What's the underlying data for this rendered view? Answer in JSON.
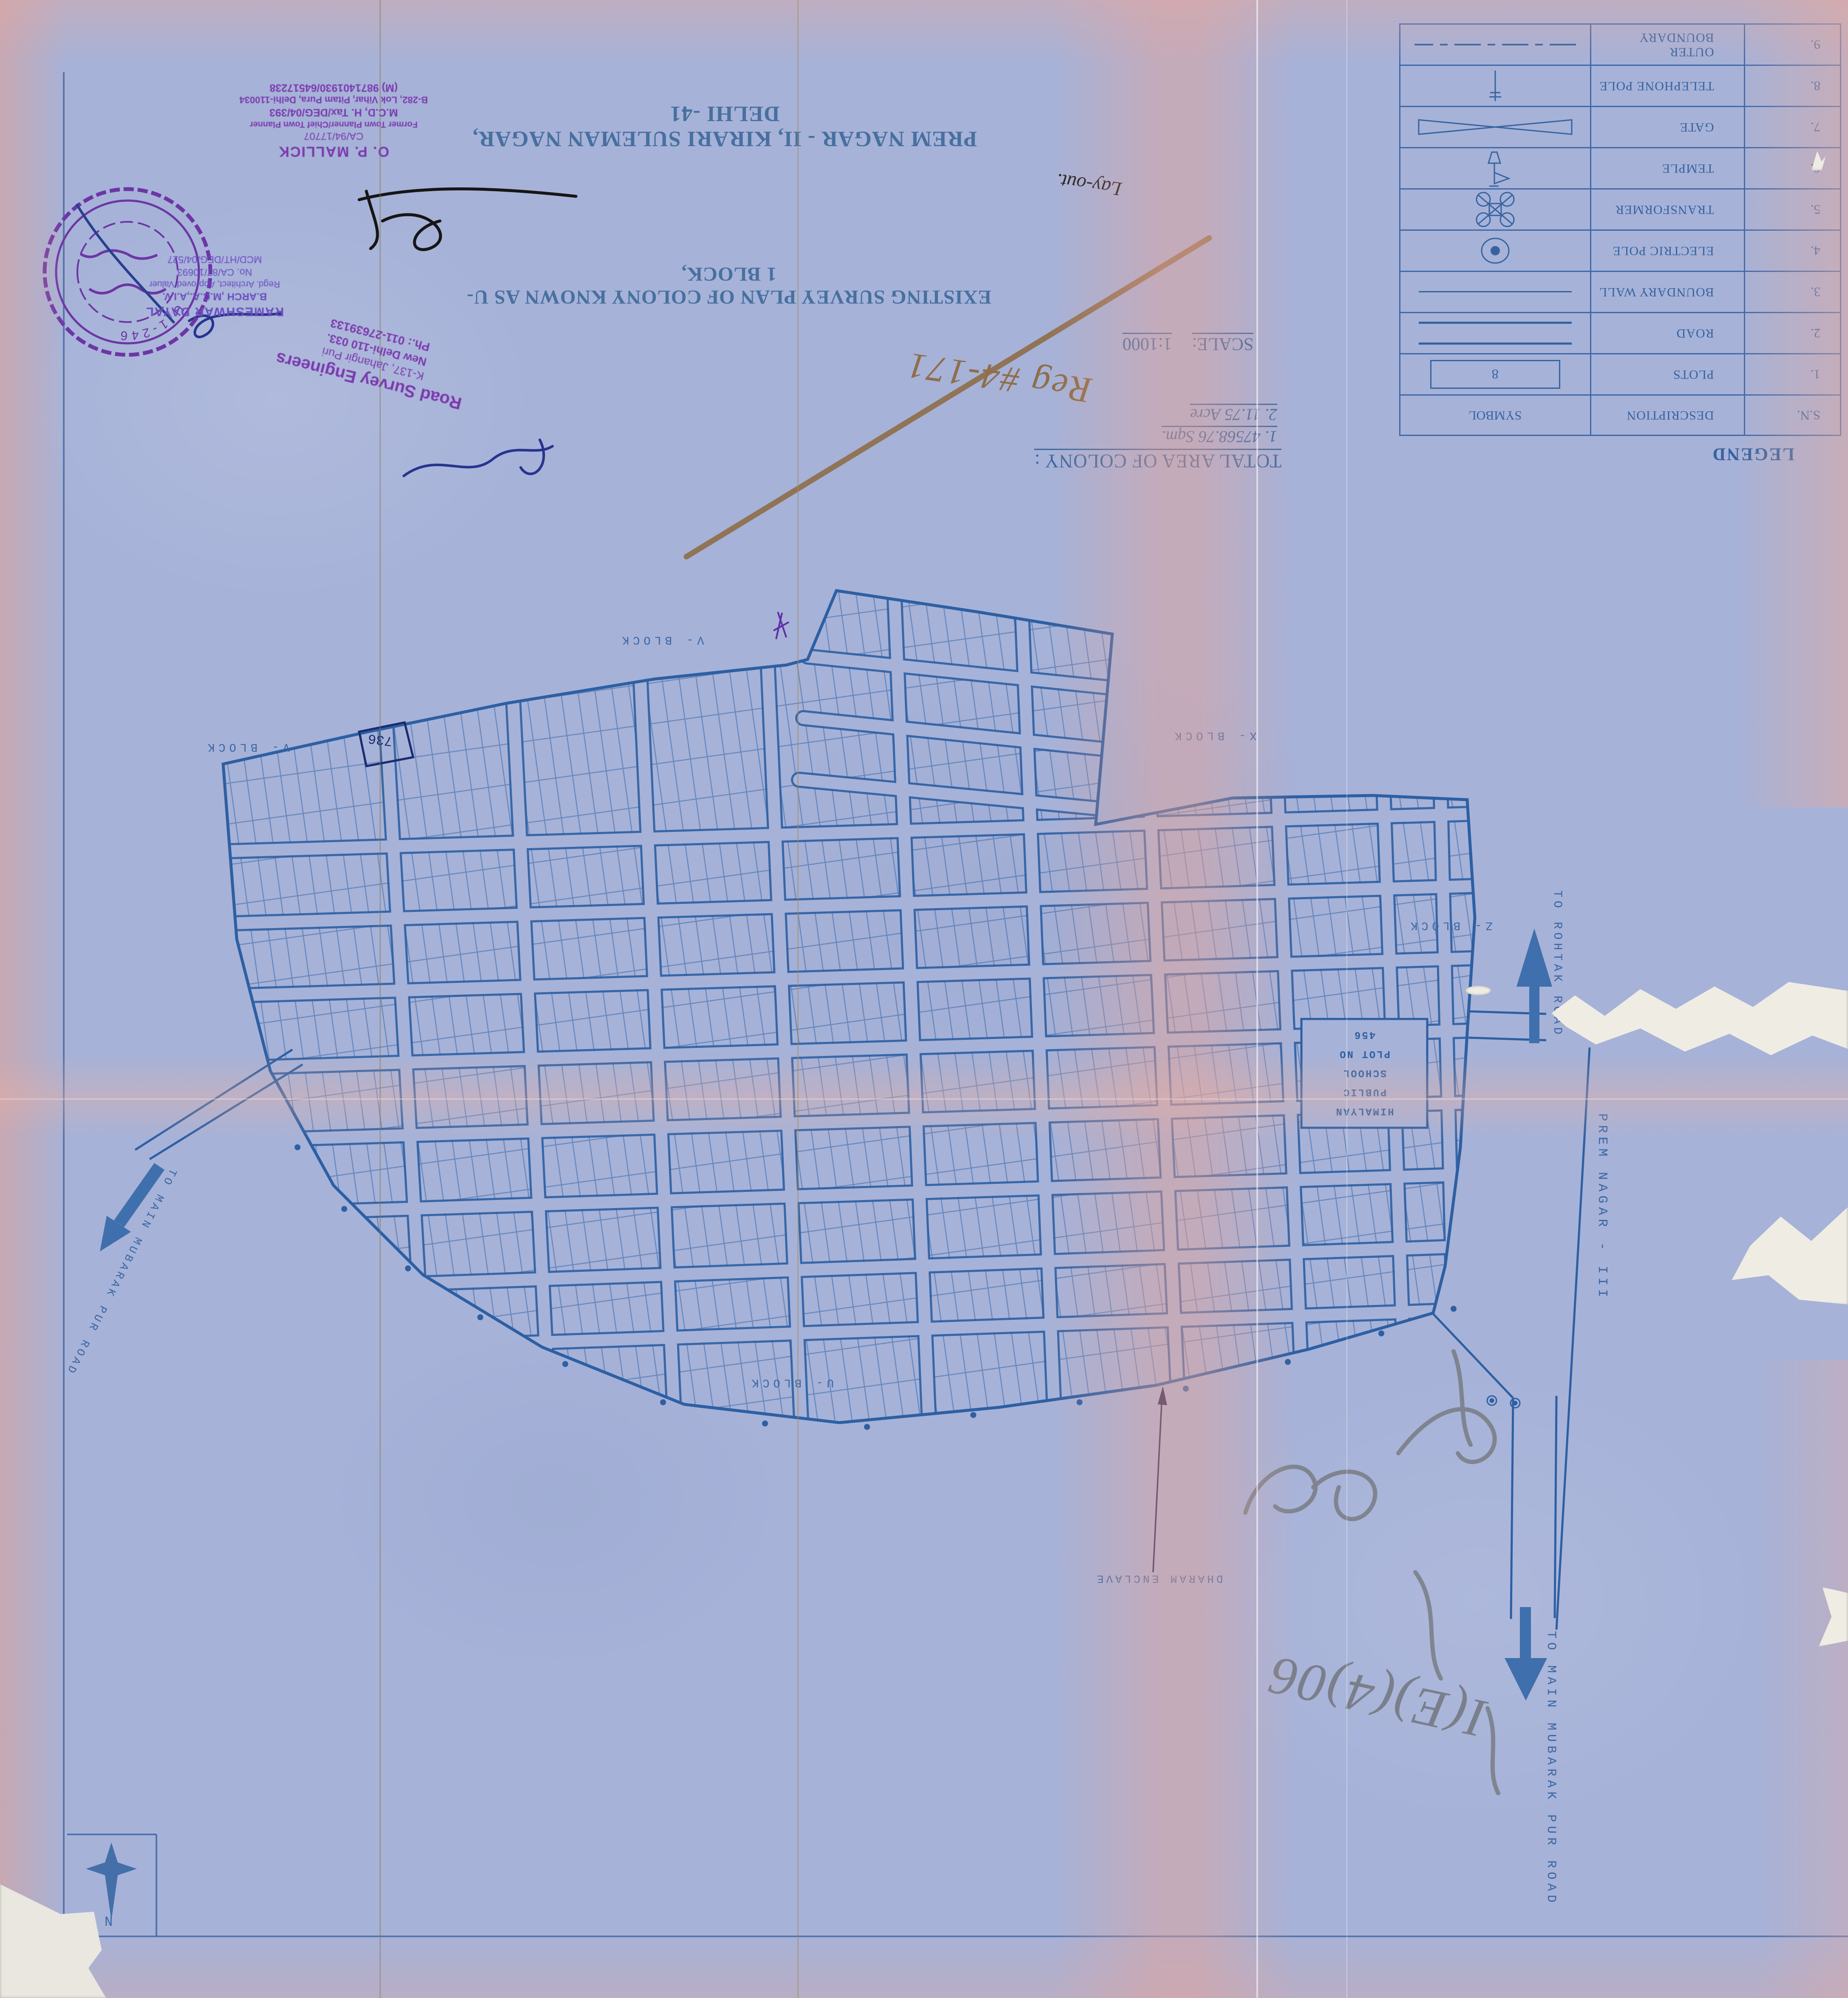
{
  "document": {
    "kind": "blueprint survey plan, scanned upside down (rotated 180°)",
    "title_line1": "EXISTING SURVEY PLAN OF COLONY KNOWN AS U-1 BLOCK,",
    "title_line2": "PREM NAGAR - II, KIRARI SULEMAN NAGAR, DELHI -41"
  },
  "scale": {
    "label": "SCALE:",
    "value": "1:1000"
  },
  "total_area": {
    "heading": "TOTAL AREA OF COLONY :",
    "item1": "1.  47568.76 Sqm.",
    "item2": "2.  11.75 Acre"
  },
  "legend": {
    "title": "LEGEND",
    "col_sn": "S.N.",
    "col_desc": "DESCRIPTION",
    "col_sym": "SYMBOL",
    "plot_symbol_number": "8",
    "rows": [
      {
        "sn": "1.",
        "desc": "PLOTS"
      },
      {
        "sn": "2.",
        "desc": "ROAD"
      },
      {
        "sn": "3.",
        "desc": "BOUNDARY WALL"
      },
      {
        "sn": "4.",
        "desc": "ELECTRIC POLE"
      },
      {
        "sn": "5.",
        "desc": "TRANSFORMER"
      },
      {
        "sn": "6.",
        "desc": "TEMPLE"
      },
      {
        "sn": "7.",
        "desc": "GATE"
      },
      {
        "sn": "8.",
        "desc": "TELEPHONE POLE"
      },
      {
        "sn": "9.",
        "desc": "OUTER BOUNDARY"
      }
    ]
  },
  "stamps": {
    "mallick": {
      "l1": "O. P. MALLICK",
      "l2": "CA/94/17707",
      "l3": "Former Town Planner/Chief Town Planner",
      "l4": "M.C.D, H. Tax/DEG/04/393",
      "l5": "B-282, Lok Vihar, Pitam Pura, Delhi-110034",
      "l6": "(M) 9871401930/64517238"
    },
    "rameshwar": {
      "l1": "RAMESHWAR DAYAL",
      "l2": "B.ARCH ,M.C.A.,A.I.V.",
      "l3": "Regd. Architect, Approved Valuer",
      "l4": "No. CA/87/10693",
      "l5": "MCD/HT/DEG/04/527"
    },
    "road_survey": {
      "l1": "Road Survey Engineers",
      "l2": "K-137, Jahangir Puri",
      "l3": "New Delhi-110 033.",
      "l4": "Ph.: 011-27639133"
    },
    "round_stamp": {
      "latin_fragment": "U-1-246",
      "other_fragments": [
        "पार्ट-II",
        "(रजि.)",
        "पास",
        "दिल्ली-41"
      ]
    }
  },
  "handwriting": {
    "layout_note": "Lay-out.",
    "reg_note": "Reg #4-171",
    "pencil_note": "I(E)(4)06"
  },
  "map": {
    "labels": {
      "v_block_left": "V- BLOCK",
      "v_block_top": "V- BLOCK",
      "x_block": "X- BLOCK",
      "z_block": "Z- BLOCK",
      "u_block": "U- BLOCK",
      "dharam": "DHARAM ENCLAVE",
      "rohtak": "TO ROHTAK ROAD",
      "mubarak_right": "TO MAIN MUBARAK PUR ROAD",
      "mubarak_left": "TO MAIN MUBARAK PUR ROAD",
      "prem_nagar_iii": "PREM NAGAR - III"
    },
    "school": {
      "l1": "HIMALYAN",
      "l2": "PUBLIC",
      "l3": "SCHOOL",
      "l4": "PLOT NO",
      "l5": "456"
    },
    "hand_plot": "736",
    "sample_plot_numbers": [
      "401",
      "422",
      "438",
      "453",
      "454",
      "455",
      "456",
      "457",
      "458",
      "459",
      "613",
      "614",
      "615",
      "616",
      "617",
      "618",
      "619",
      "620",
      "627",
      "634",
      "635",
      "643",
      "644",
      "645",
      "646",
      "647",
      "648",
      "649",
      "650",
      "730",
      "731",
      "733",
      "734",
      "735",
      "736"
    ]
  },
  "compass": {
    "n": "N"
  },
  "colors": {
    "paper": "#a6b2d8",
    "blueprint_ink": "#2d5fa3",
    "title_ink": "#47709f",
    "stamp_purple": "#7b39ae",
    "stamp_violet": "#6a4cc0",
    "signature_blue": "#27348f",
    "marker_brown": "#8f6e49",
    "pencil_grey": "#6f7378",
    "arrow_steel_blue": "#3f6fad",
    "pink_band": "#e8a79b"
  }
}
